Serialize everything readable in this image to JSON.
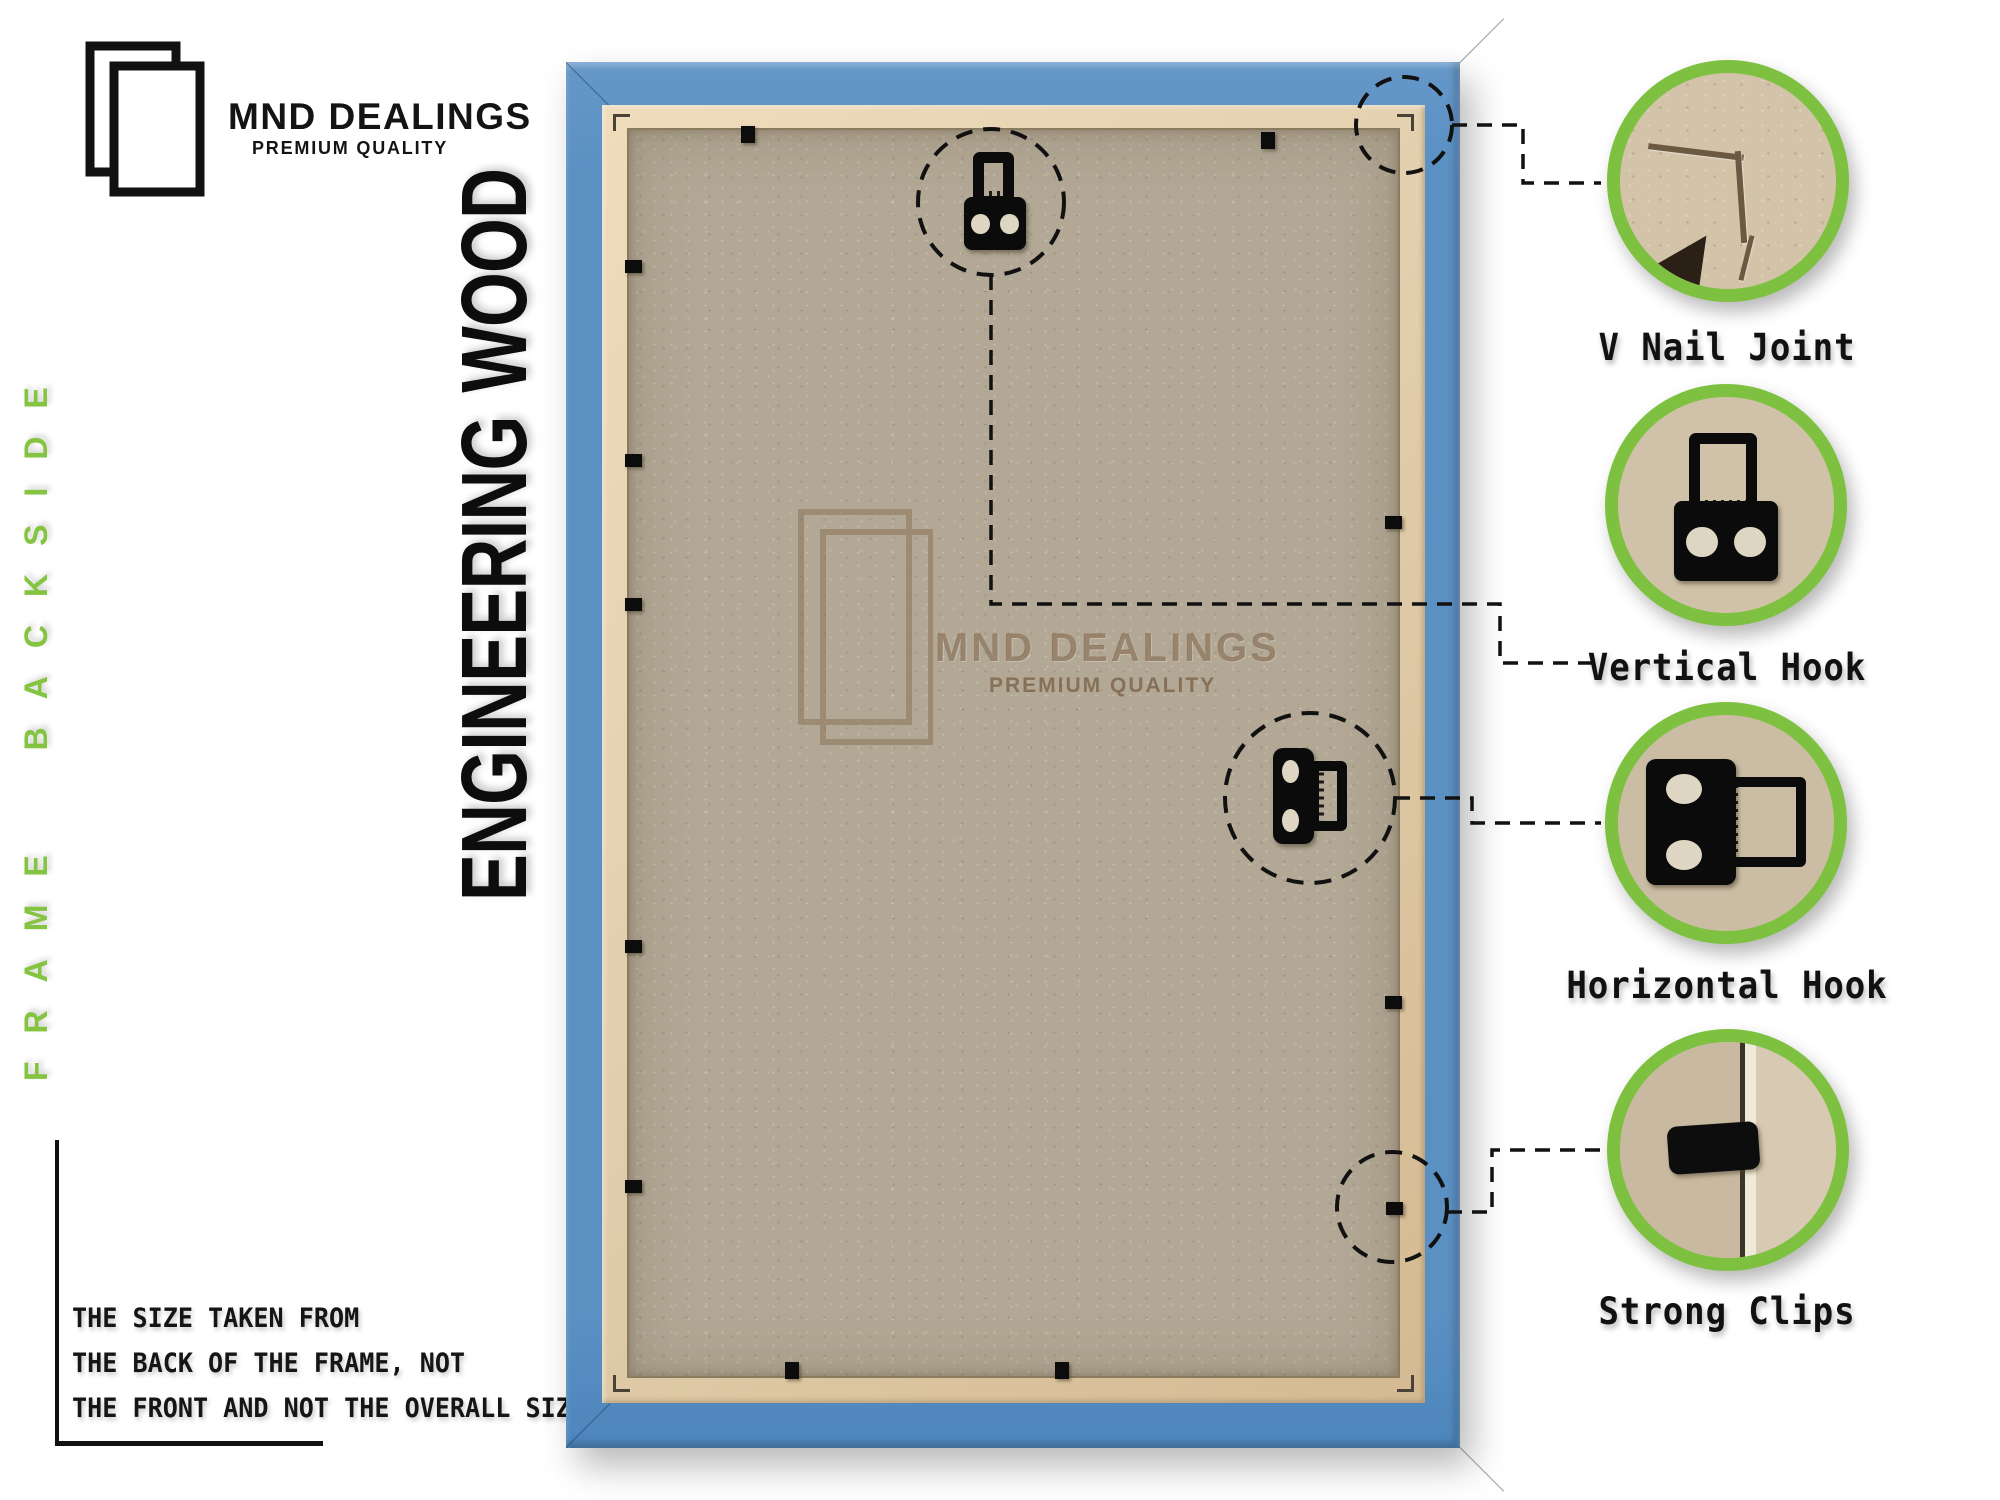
{
  "brand": {
    "name": "MND DEALINGS",
    "tagline": "PREMIUM QUALITY"
  },
  "side_label": "FRAME BACKSIDE",
  "vertical_title": "ENGINEERING WOOD",
  "note": {
    "line1": "THE SIZE TAKEN FROM",
    "line2": "THE BACK OF THE FRAME, NOT",
    "line3": "THE FRONT AND NOT THE OVERALL SIZE."
  },
  "watermark": {
    "name": "MND DEALINGS",
    "tagline": "PREMIUM QUALITY"
  },
  "callouts": [
    {
      "id": "v-nail-joint",
      "label": "V Nail Joint"
    },
    {
      "id": "vertical-hook",
      "label": "Vertical Hook"
    },
    {
      "id": "horizontal-hook",
      "label": "Horizontal Hook"
    },
    {
      "id": "strong-clips",
      "label": "Strong Clips"
    }
  ],
  "colors": {
    "accent_green": "#7ec141",
    "side_label_green": "#84c441",
    "frame_blue": "#5b90c3",
    "lip_tan": "#e2cfae",
    "mdf_tan": "#b2a895",
    "watermark_brown": "#8d7257",
    "text_black": "#111111"
  }
}
